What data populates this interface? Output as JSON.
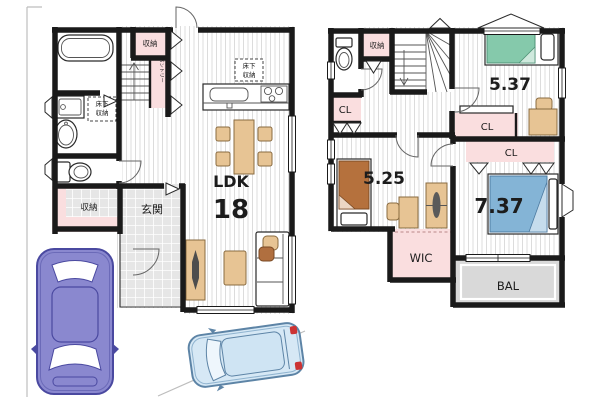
{
  "floor1": {
    "ldk_label": "LDK",
    "ldk_size": "18",
    "entrance": "玄関",
    "entrance_storage": "収納",
    "stair_storage": "収納",
    "pantry": "パントリー",
    "underfloor_wash_line1": "床下",
    "underfloor_wash_line2": "収納",
    "underfloor_kitchen_line1": "床下",
    "underfloor_kitchen_line2": "収納"
  },
  "floor2": {
    "bedroom_top_size": "5.37",
    "bedroom_left_size": "5.25",
    "bedroom_main_size": "7.37",
    "closet_left": "CL",
    "closet_mid": "CL",
    "closet_right": "CL",
    "hall_storage": "収納",
    "walk_in_closet": "WIC",
    "balcony": "BAL"
  },
  "colors": {
    "wall": "#1a1a1a",
    "storage_pink": "#fadedf",
    "balcony_gray": "#d9d9d9",
    "bed_green": "#85c9ab",
    "bed_brown": "#b5713d",
    "bed_blue": "#84b4d6",
    "furniture_tan": "#e7c494",
    "car_purple": "#8a88cf",
    "car_blue": "#d6e8f5"
  }
}
